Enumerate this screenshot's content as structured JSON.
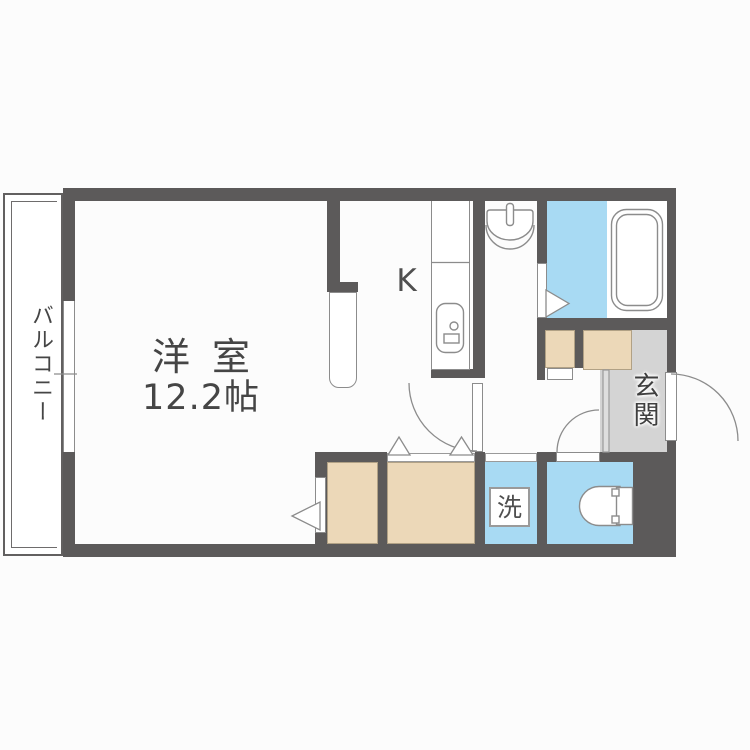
{
  "canvas": {
    "width": 750,
    "height": 750,
    "background": "#fcfcfc"
  },
  "floorplan": {
    "kind": "japanese-apartment-floor-plan",
    "labels": {
      "main_room": "洋室",
      "main_room_size": "12.2帖",
      "kitchen": "K",
      "balcony": "バルコニー",
      "entrance": "玄関",
      "laundry": "洗"
    },
    "colors": {
      "wall": "#5c5a5a",
      "wet_area_blue": "#a8daf3",
      "storage_beige": "#ecd8b8",
      "entrance_gray": "#d4d4d4",
      "fixture_line": "#8c8c8c",
      "text": "#454545",
      "background": "#fcfcfc"
    }
  }
}
